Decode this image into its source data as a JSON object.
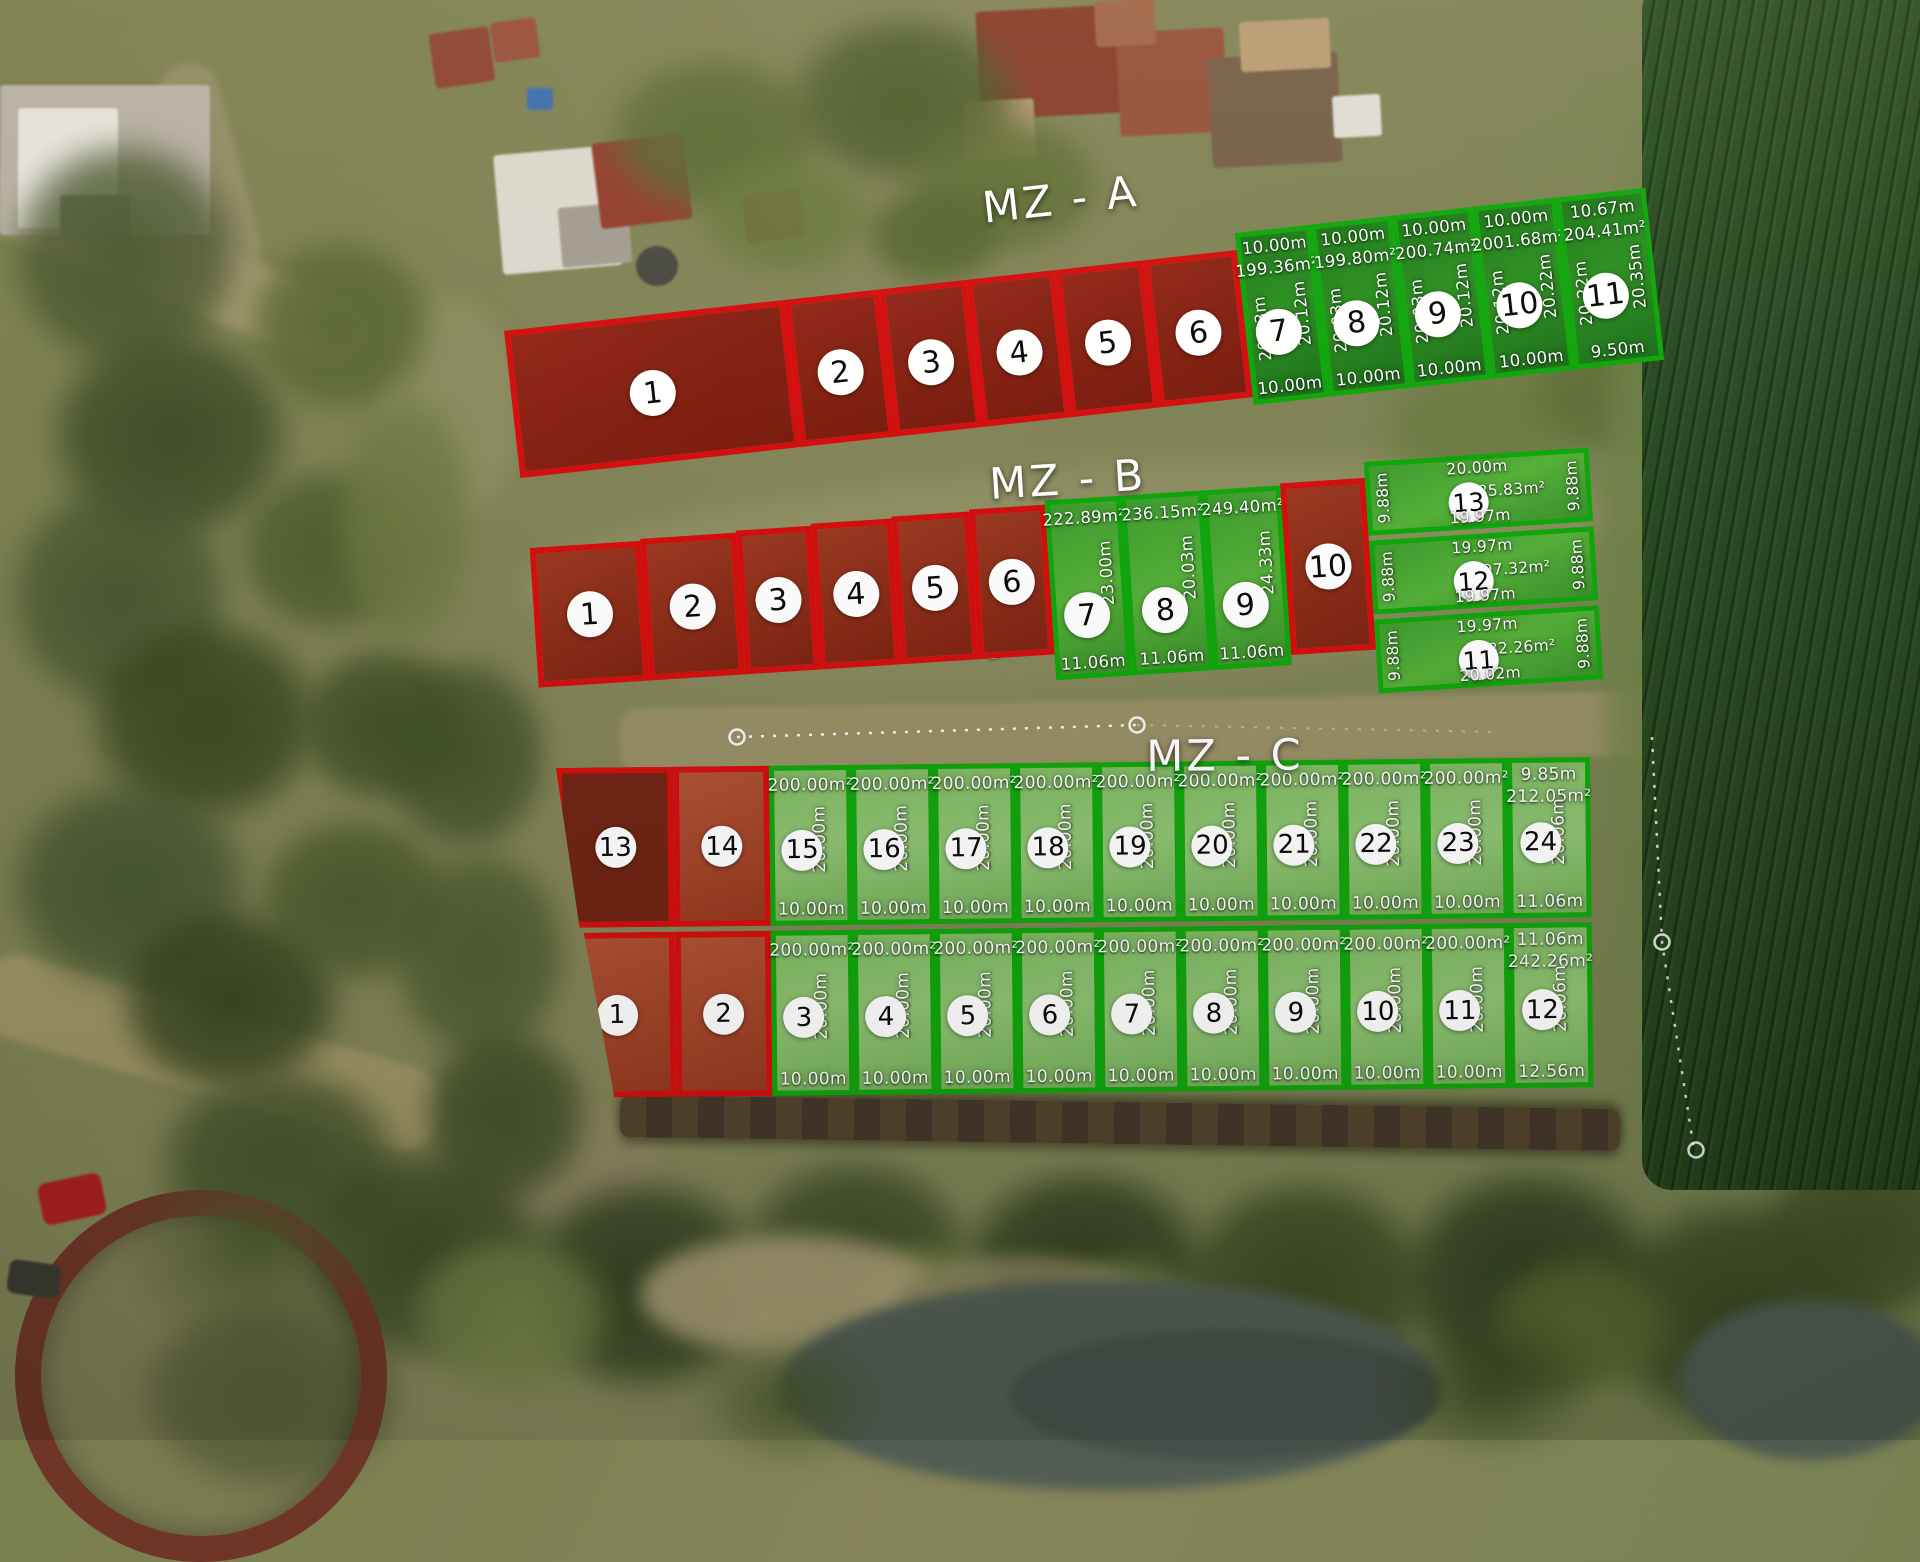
{
  "map_overlay": {
    "legend_colors": {
      "available_border": "#0fa70c",
      "sold_border": "#d40f0f"
    },
    "blocks": [
      {
        "id": "mza",
        "title": "MZ - A",
        "lots": [
          {
            "num": "1",
            "status": "sold"
          },
          {
            "num": "2",
            "status": "sold"
          },
          {
            "num": "3",
            "status": "sold"
          },
          {
            "num": "4",
            "status": "sold"
          },
          {
            "num": "5",
            "status": "sold"
          },
          {
            "num": "6",
            "status": "sold"
          },
          {
            "num": "7",
            "status": "available",
            "top": "10.00m",
            "area": "199.36m²",
            "left": "20.03m",
            "right": "20.12m",
            "bottom": "10.00m"
          },
          {
            "num": "8",
            "status": "available",
            "top": "10.00m",
            "area": "199.80m²",
            "left": "20.03m",
            "right": "20.12m",
            "bottom": "10.00m"
          },
          {
            "num": "9",
            "status": "available",
            "top": "10.00m",
            "area": "200.74m²",
            "left": "20.03m",
            "right": "20.12m",
            "bottom": "10.00m"
          },
          {
            "num": "10",
            "status": "available",
            "top": "10.00m",
            "area": "2001.68m²",
            "left": "20.12m",
            "right": "20.22m",
            "bottom": "10.00m"
          },
          {
            "num": "11",
            "status": "available",
            "top": "10.67m",
            "area": "204.41m²",
            "left": "20.22m",
            "right": "20.35m",
            "bottom": "9.50m"
          }
        ]
      },
      {
        "id": "mzb",
        "title": "MZ - B",
        "lots": [
          {
            "num": "1",
            "status": "sold"
          },
          {
            "num": "2",
            "status": "sold"
          },
          {
            "num": "3",
            "status": "sold"
          },
          {
            "num": "4",
            "status": "sold"
          },
          {
            "num": "5",
            "status": "sold"
          },
          {
            "num": "6",
            "status": "sold"
          },
          {
            "num": "7",
            "status": "available",
            "area": "222.89m²",
            "right": "23.00m",
            "bottom": "11.06m"
          },
          {
            "num": "8",
            "status": "available",
            "area": "236.15m²",
            "right": "20.03m",
            "bottom": "11.06m"
          },
          {
            "num": "9",
            "status": "available",
            "area": "249.40m²",
            "right": "24.33m",
            "bottom": "11.06m"
          },
          {
            "num": "10",
            "status": "sold"
          }
        ],
        "stacked_lots": [
          {
            "num": "13",
            "status": "available",
            "top": "20.00m",
            "area": "185.83m²",
            "left": "9.88m",
            "right": "9.88m",
            "bottom": "19.97m"
          },
          {
            "num": "12",
            "status": "available",
            "top": "19.97m",
            "area": "197.32m²",
            "left": "9.88m",
            "right": "9.88m",
            "bottom": "19.97m"
          },
          {
            "num": "11",
            "status": "available",
            "top": "19.97m",
            "area": "182.26m²",
            "left": "9.88m",
            "right": "9.88m",
            "bottom": "20.02m"
          }
        ]
      },
      {
        "id": "mzc",
        "title": "MZ - C",
        "row_top": [
          {
            "num": "13",
            "status": "sold"
          },
          {
            "num": "14",
            "status": "sold"
          },
          {
            "num": "15",
            "status": "available",
            "area": "200.00m²",
            "side": "20.00m",
            "bottom": "10.00m"
          },
          {
            "num": "16",
            "status": "available",
            "area": "200.00m²",
            "side": "20.00m",
            "bottom": "10.00m"
          },
          {
            "num": "17",
            "status": "available",
            "area": "200.00m²",
            "side": "20.00m",
            "bottom": "10.00m"
          },
          {
            "num": "18",
            "status": "available",
            "area": "200.00m²",
            "side": "20.00m",
            "bottom": "10.00m"
          },
          {
            "num": "19",
            "status": "available",
            "area": "200.00m²",
            "side": "20.00m",
            "bottom": "10.00m"
          },
          {
            "num": "20",
            "status": "available",
            "area": "200.00m²",
            "side": "20.00m",
            "bottom": "10.00m"
          },
          {
            "num": "21",
            "status": "available",
            "area": "200.00m²",
            "side": "20.00m",
            "bottom": "10.00m"
          },
          {
            "num": "22",
            "status": "available",
            "area": "200.00m²",
            "side": "20.00m",
            "bottom": "10.00m"
          },
          {
            "num": "23",
            "status": "available",
            "area": "200.00m²",
            "side": "20.00m",
            "bottom": "10.00m"
          },
          {
            "num": "24",
            "status": "available",
            "top": "9.85m",
            "area": "212.05m²",
            "side": "20.06m",
            "bottom": "11.06m"
          }
        ],
        "row_bottom": [
          {
            "num": "1",
            "status": "sold"
          },
          {
            "num": "2",
            "status": "sold"
          },
          {
            "num": "3",
            "status": "available",
            "area": "200.00m²",
            "side": "20.00m",
            "bottom": "10.00m"
          },
          {
            "num": "4",
            "status": "available",
            "area": "200.00m²",
            "side": "20.00m",
            "bottom": "10.00m"
          },
          {
            "num": "5",
            "status": "available",
            "area": "200.00m²",
            "side": "20.00m",
            "bottom": "10.00m"
          },
          {
            "num": "6",
            "status": "available",
            "area": "200.00m²",
            "side": "20.00m",
            "bottom": "10.00m"
          },
          {
            "num": "7",
            "status": "available",
            "area": "200.00m²",
            "side": "20.00m",
            "bottom": "10.00m"
          },
          {
            "num": "8",
            "status": "available",
            "area": "200.00m²",
            "side": "20.00m",
            "bottom": "10.00m"
          },
          {
            "num": "9",
            "status": "available",
            "area": "200.00m²",
            "side": "20.00m",
            "bottom": "10.00m"
          },
          {
            "num": "10",
            "status": "available",
            "area": "200.00m²",
            "side": "20.00m",
            "bottom": "10.00m"
          },
          {
            "num": "11",
            "status": "available",
            "area": "200.00m²",
            "side": "20.00m",
            "bottom": "10.00m"
          },
          {
            "num": "12",
            "status": "available",
            "top": "11.06m",
            "area": "242.26m²",
            "side": "20.06m",
            "bottom": "12.56m"
          }
        ]
      }
    ]
  }
}
